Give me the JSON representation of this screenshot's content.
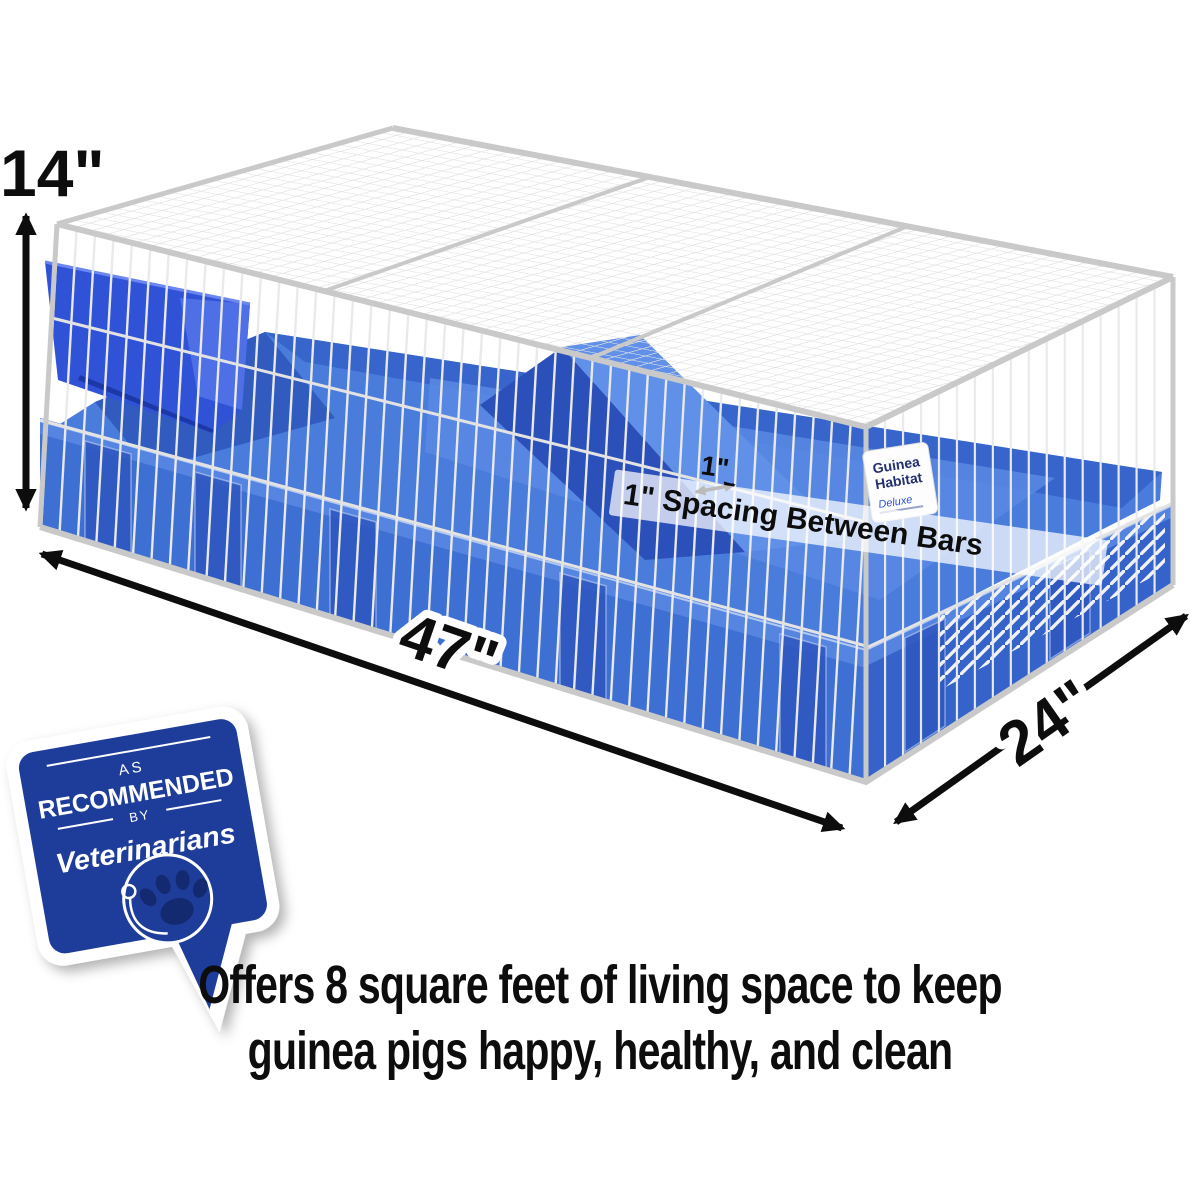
{
  "annotations": {
    "height": "14\"",
    "length": "47\"",
    "depth": "24\"",
    "spacing_short": "1\"",
    "spacing_note": "1\" Spacing Between Bars"
  },
  "cage_label": {
    "brand_line1": "Guinea",
    "brand_line2": "Habitat",
    "brand_line3": "Deluxe"
  },
  "badge": {
    "as": "AS",
    "recommended": "RECOMMENDED",
    "by": "BY",
    "veterinarians": "Veterinarians"
  },
  "caption": {
    "line1": "Offers 8 square feet of living space to keep",
    "line2": "guinea pigs happy, healthy, and clean"
  },
  "icons": {
    "paw": "paw-print-icon",
    "stethoscope": "stethoscope-icon",
    "dimension_arrow": "double-headed-arrow-icon"
  },
  "colors": {
    "canvas_blue": "#3e6fd2",
    "canvas_light": "#5b89e4",
    "canvas_dark": "#2b53b8",
    "canvas_floor": "#4a7cdc",
    "canvas_back": "#3563c9",
    "pocket_blue": "#2f58bf",
    "feeder_blue": "#2f52d6",
    "feeder_light": "#4e6fe6",
    "feeder_dark": "#1c38a8",
    "ramp_dark": "#2c50ba",
    "ramp_light": "#6090e8",
    "badge_navy": "#1e3c99",
    "paw_navy": "#142a70",
    "wire_gray": "#e9eaec",
    "frame_gray": "#c9c9c9",
    "text_black": "#0d0d0d"
  }
}
